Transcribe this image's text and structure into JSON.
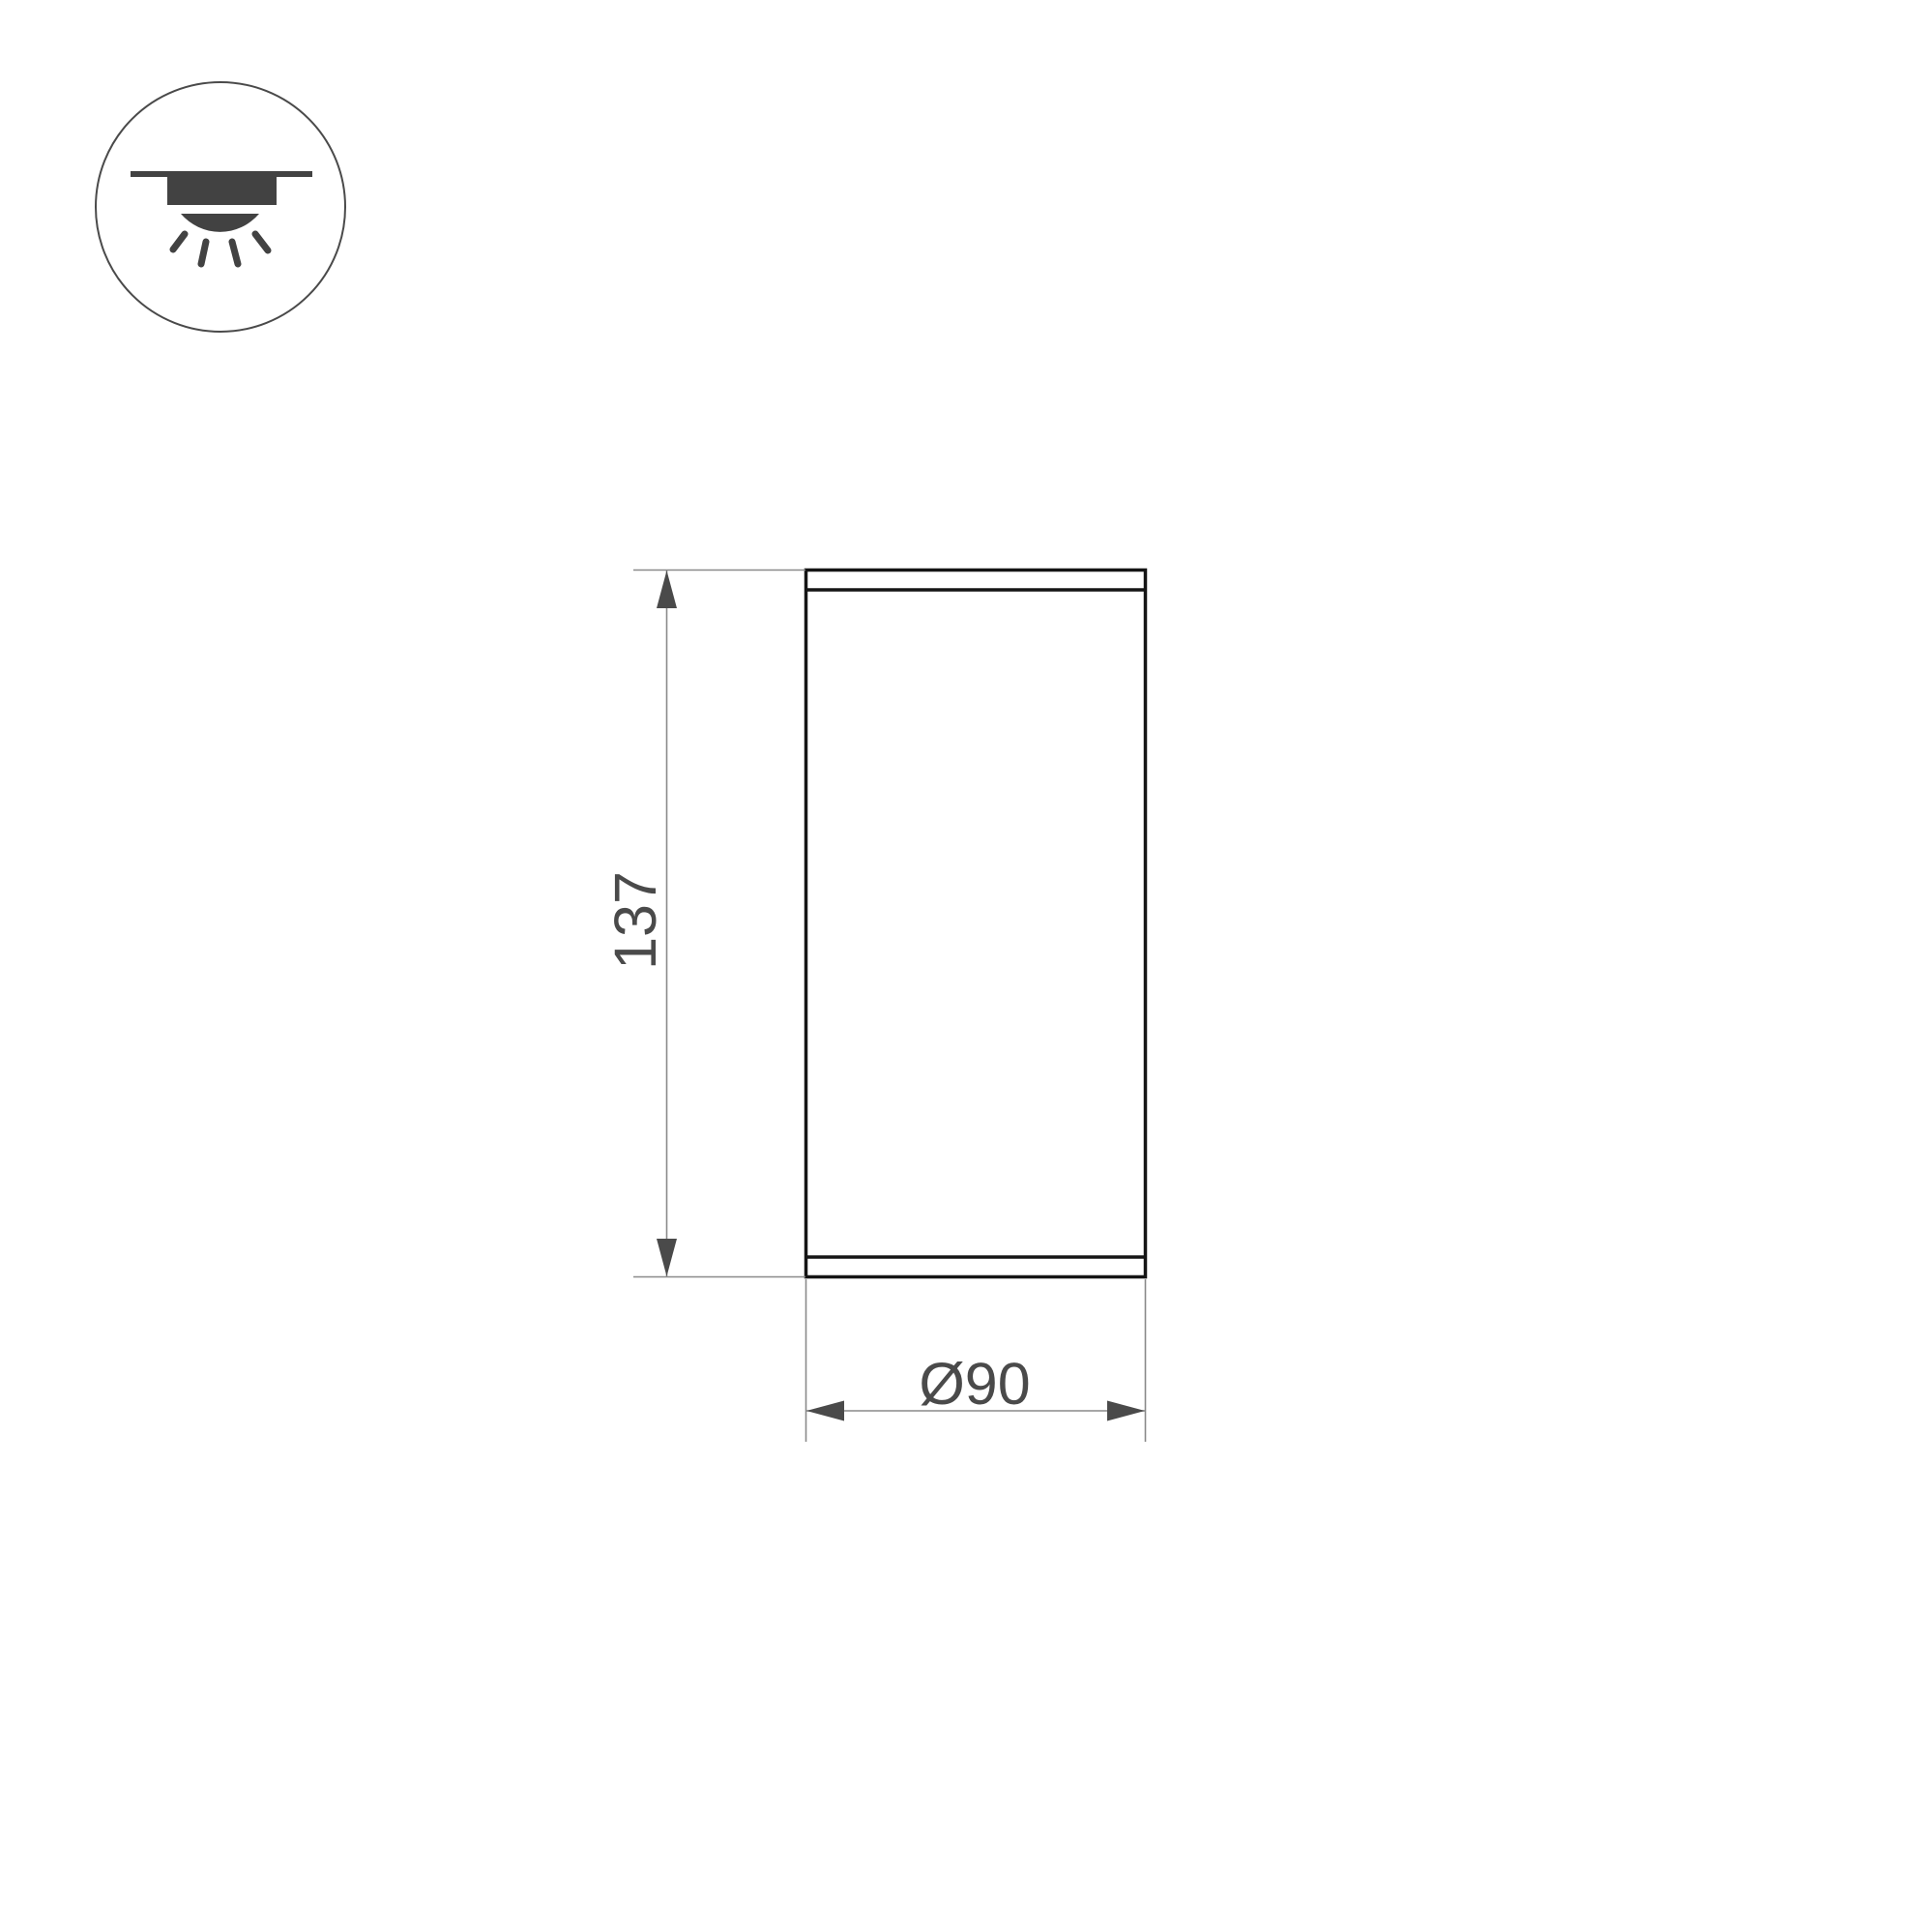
{
  "icons": {
    "mount_type_icon": "surface-mounted-ceiling-downlight"
  },
  "dimensions": {
    "height": {
      "value": "137"
    },
    "diameter": {
      "value": "Ø90"
    }
  },
  "colors": {
    "bg": "#ffffff",
    "outline": "#151515",
    "thin-line": "#8a8a8a",
    "annotation": "#4a4a4a",
    "icon-ink": "#424242"
  }
}
